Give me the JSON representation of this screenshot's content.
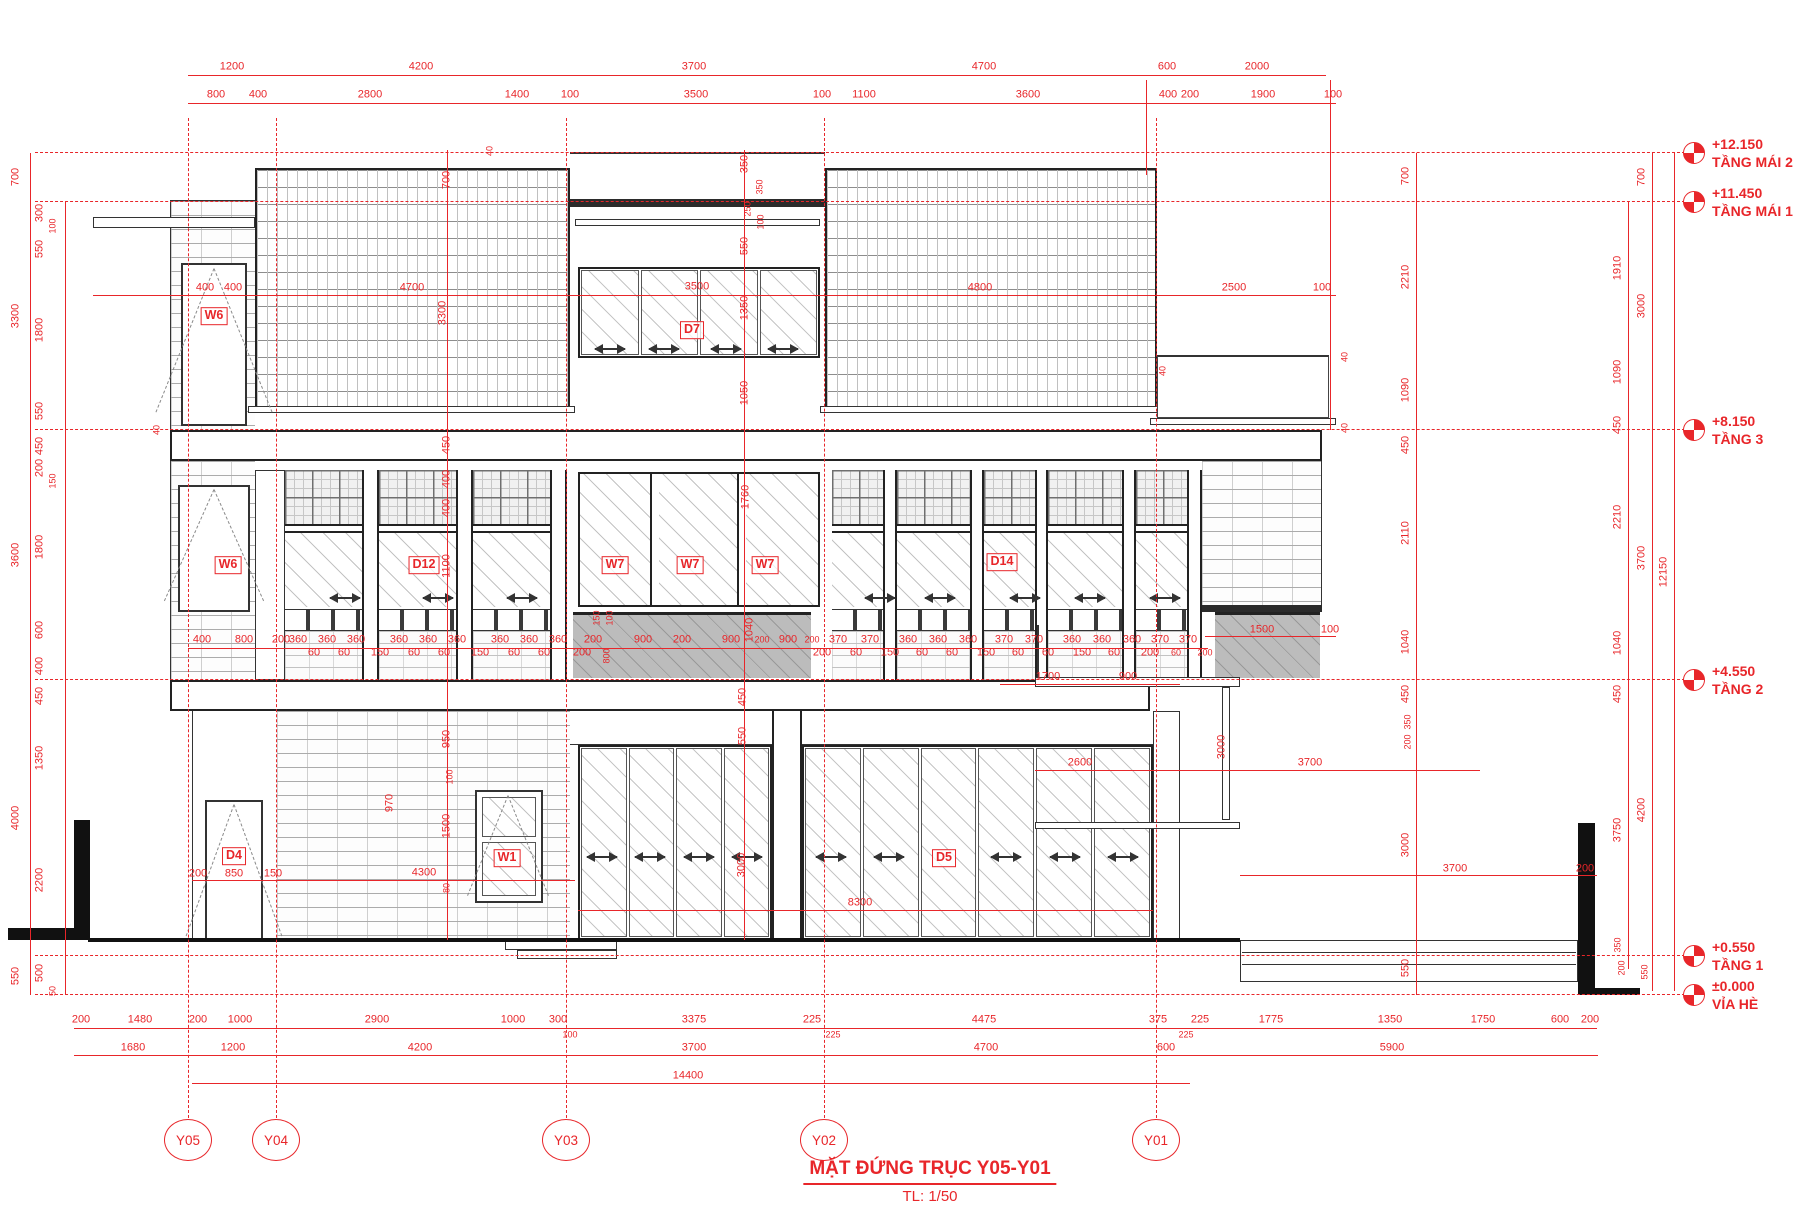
{
  "title": {
    "main": "MẶT ĐỨNG TRỤC Y05-Y01",
    "scale": "TL: 1/50"
  },
  "colors": {
    "red": "#e8262a",
    "line": "#222222"
  },
  "levels": [
    {
      "elev": "+12.150",
      "name": "TẦNG MÁI 2",
      "y": 153
    },
    {
      "elev": "+11.450",
      "name": "TẦNG MÁI 1",
      "y": 202
    },
    {
      "elev": "+8.150",
      "name": "TẦNG 3",
      "y": 430
    },
    {
      "elev": "+4.550",
      "name": "TẦNG 2",
      "y": 680
    },
    {
      "elev": "+0.550",
      "name": "TẦNG 1",
      "y": 956
    },
    {
      "elev": "±0.000",
      "name": "VỈA HÈ",
      "y": 995
    }
  ],
  "axes": [
    {
      "label": "Y05",
      "x": 188
    },
    {
      "label": "Y04",
      "x": 276
    },
    {
      "label": "Y03",
      "x": 566
    },
    {
      "label": "Y02",
      "x": 824
    },
    {
      "label": "Y01",
      "x": 1156
    }
  ],
  "tags": [
    {
      "t": "W6",
      "x": 214,
      "y": 316
    },
    {
      "t": "D7",
      "x": 692,
      "y": 330
    },
    {
      "t": "W6",
      "x": 228,
      "y": 565
    },
    {
      "t": "D12",
      "x": 424,
      "y": 565
    },
    {
      "t": "W7",
      "x": 615,
      "y": 565
    },
    {
      "t": "W7",
      "x": 690,
      "y": 565
    },
    {
      "t": "W7",
      "x": 765,
      "y": 565
    },
    {
      "t": "D14",
      "x": 1002,
      "y": 562
    },
    {
      "t": "D4",
      "x": 234,
      "y": 856
    },
    {
      "t": "W1",
      "x": 507,
      "y": 858
    },
    {
      "t": "D5",
      "x": 944,
      "y": 858
    }
  ],
  "dims": [
    {
      "t": "1200",
      "x": 232,
      "y": 67
    },
    {
      "t": "4200",
      "x": 421,
      "y": 67
    },
    {
      "t": "3700",
      "x": 694,
      "y": 67
    },
    {
      "t": "4700",
      "x": 984,
      "y": 67
    },
    {
      "t": "600",
      "x": 1167,
      "y": 67
    },
    {
      "t": "2000",
      "x": 1257,
      "y": 67
    },
    {
      "t": "800",
      "x": 216,
      "y": 95
    },
    {
      "t": "400",
      "x": 258,
      "y": 95
    },
    {
      "t": "2800",
      "x": 370,
      "y": 95
    },
    {
      "t": "1400",
      "x": 517,
      "y": 95
    },
    {
      "t": "100",
      "x": 570,
      "y": 95
    },
    {
      "t": "3500",
      "x": 696,
      "y": 95
    },
    {
      "t": "100",
      "x": 822,
      "y": 95
    },
    {
      "t": "1100",
      "x": 864,
      "y": 95
    },
    {
      "t": "3600",
      "x": 1028,
      "y": 95
    },
    {
      "t": "400",
      "x": 1168,
      "y": 95
    },
    {
      "t": "200",
      "x": 1190,
      "y": 95
    },
    {
      "t": "1900",
      "x": 1263,
      "y": 95
    },
    {
      "t": "100",
      "x": 1333,
      "y": 95
    },
    {
      "t": "700",
      "x": 16,
      "y": 177,
      "r": 1
    },
    {
      "t": "3300",
      "x": 16,
      "y": 316,
      "r": 1
    },
    {
      "t": "3600",
      "x": 16,
      "y": 555,
      "r": 1
    },
    {
      "t": "4000",
      "x": 16,
      "y": 818,
      "r": 1
    },
    {
      "t": "550",
      "x": 16,
      "y": 976,
      "r": 1
    },
    {
      "t": "300",
      "x": 40,
      "y": 213,
      "r": 1
    },
    {
      "t": "550",
      "x": 40,
      "y": 249,
      "r": 1
    },
    {
      "t": "1800",
      "x": 40,
      "y": 330,
      "r": 1
    },
    {
      "t": "550",
      "x": 40,
      "y": 411,
      "r": 1
    },
    {
      "t": "450",
      "x": 40,
      "y": 446,
      "r": 1
    },
    {
      "t": "200",
      "x": 40,
      "y": 468,
      "r": 1
    },
    {
      "t": "1800",
      "x": 40,
      "y": 547,
      "r": 1
    },
    {
      "t": "600",
      "x": 40,
      "y": 630,
      "r": 1
    },
    {
      "t": "400",
      "x": 40,
      "y": 666,
      "r": 1
    },
    {
      "t": "450",
      "x": 40,
      "y": 696,
      "r": 1
    },
    {
      "t": "1350",
      "x": 40,
      "y": 758,
      "r": 1
    },
    {
      "t": "2200",
      "x": 40,
      "y": 880,
      "r": 1
    },
    {
      "t": "500",
      "x": 40,
      "y": 973,
      "r": 1
    },
    {
      "t": "100",
      "x": 53,
      "y": 226,
      "r": 1,
      "s": 1
    },
    {
      "t": "150",
      "x": 53,
      "y": 481,
      "r": 1,
      "s": 1
    },
    {
      "t": "50",
      "x": 53,
      "y": 991,
      "r": 1,
      "s": 1
    },
    {
      "t": "400",
      "x": 205,
      "y": 288
    },
    {
      "t": "400",
      "x": 233,
      "y": 288
    },
    {
      "t": "4700",
      "x": 412,
      "y": 288
    },
    {
      "t": "3500",
      "x": 697,
      "y": 287
    },
    {
      "t": "4800",
      "x": 980,
      "y": 288
    },
    {
      "t": "2500",
      "x": 1234,
      "y": 288
    },
    {
      "t": "100",
      "x": 1322,
      "y": 288
    },
    {
      "t": "350",
      "x": 745,
      "y": 164,
      "r": 1
    },
    {
      "t": "350",
      "x": 760,
      "y": 187,
      "r": 1,
      "s": 1
    },
    {
      "t": "250",
      "x": 748,
      "y": 209,
      "r": 1,
      "s": 1
    },
    {
      "t": "100",
      "x": 761,
      "y": 222,
      "r": 1,
      "s": 1
    },
    {
      "t": "550",
      "x": 745,
      "y": 246,
      "r": 1
    },
    {
      "t": "1350",
      "x": 745,
      "y": 308,
      "r": 1
    },
    {
      "t": "1050",
      "x": 745,
      "y": 393,
      "r": 1
    },
    {
      "t": "700",
      "x": 447,
      "y": 180,
      "r": 1
    },
    {
      "t": "3300",
      "x": 443,
      "y": 313,
      "r": 1
    },
    {
      "t": "450",
      "x": 447,
      "y": 445,
      "r": 1
    },
    {
      "t": "400",
      "x": 447,
      "y": 479,
      "r": 1
    },
    {
      "t": "400",
      "x": 447,
      "y": 508,
      "r": 1
    },
    {
      "t": "1100",
      "x": 447,
      "y": 566,
      "r": 1
    },
    {
      "t": "950",
      "x": 447,
      "y": 739,
      "r": 1
    },
    {
      "t": "100",
      "x": 450,
      "y": 777,
      "r": 1,
      "s": 1
    },
    {
      "t": "1500",
      "x": 447,
      "y": 826,
      "r": 1
    },
    {
      "t": "80",
      "x": 447,
      "y": 888,
      "r": 1,
      "s": 1
    },
    {
      "t": "970",
      "x": 390,
      "y": 803,
      "r": 1
    },
    {
      "t": "1760",
      "x": 746,
      "y": 497,
      "r": 1
    },
    {
      "t": "1040",
      "x": 750,
      "y": 630,
      "r": 1
    },
    {
      "t": "450",
      "x": 743,
      "y": 697,
      "r": 1
    },
    {
      "t": "550",
      "x": 743,
      "y": 736,
      "r": 1
    },
    {
      "t": "3000",
      "x": 742,
      "y": 865,
      "r": 1
    },
    {
      "t": "40",
      "x": 490,
      "y": 151,
      "r": 1,
      "s": 1
    },
    {
      "t": "40",
      "x": 157,
      "y": 430,
      "r": 1,
      "s": 1
    },
    {
      "t": "40",
      "x": 1163,
      "y": 371,
      "r": 1,
      "s": 1
    },
    {
      "t": "40",
      "x": 1345,
      "y": 357,
      "r": 1,
      "s": 1
    },
    {
      "t": "40",
      "x": 1345,
      "y": 428,
      "r": 1,
      "s": 1
    },
    {
      "t": "700",
      "x": 1406,
      "y": 176,
      "r": 1
    },
    {
      "t": "2210",
      "x": 1406,
      "y": 277,
      "r": 1
    },
    {
      "t": "1090",
      "x": 1406,
      "y": 390,
      "r": 1
    },
    {
      "t": "450",
      "x": 1406,
      "y": 445,
      "r": 1
    },
    {
      "t": "2110",
      "x": 1406,
      "y": 533,
      "r": 1
    },
    {
      "t": "1040",
      "x": 1406,
      "y": 642,
      "r": 1
    },
    {
      "t": "450",
      "x": 1406,
      "y": 694,
      "r": 1
    },
    {
      "t": "350",
      "x": 1408,
      "y": 722,
      "r": 1,
      "s": 1
    },
    {
      "t": "200",
      "x": 1408,
      "y": 742,
      "r": 1,
      "s": 1
    },
    {
      "t": "3000",
      "x": 1406,
      "y": 845,
      "r": 1
    },
    {
      "t": "550",
      "x": 1406,
      "y": 968,
      "r": 1
    },
    {
      "t": "1910",
      "x": 1618,
      "y": 268,
      "r": 1
    },
    {
      "t": "1090",
      "x": 1618,
      "y": 372,
      "r": 1
    },
    {
      "t": "450",
      "x": 1618,
      "y": 425,
      "r": 1
    },
    {
      "t": "2210",
      "x": 1618,
      "y": 517,
      "r": 1
    },
    {
      "t": "1040",
      "x": 1618,
      "y": 643,
      "r": 1
    },
    {
      "t": "450",
      "x": 1618,
      "y": 694,
      "r": 1
    },
    {
      "t": "3750",
      "x": 1618,
      "y": 830,
      "r": 1
    },
    {
      "t": "350",
      "x": 1618,
      "y": 945,
      "r": 1,
      "s": 1
    },
    {
      "t": "200",
      "x": 1622,
      "y": 968,
      "r": 1,
      "s": 1
    },
    {
      "t": "700",
      "x": 1642,
      "y": 177,
      "r": 1
    },
    {
      "t": "3000",
      "x": 1642,
      "y": 306,
      "r": 1
    },
    {
      "t": "3700",
      "x": 1642,
      "y": 558,
      "r": 1
    },
    {
      "t": "4200",
      "x": 1642,
      "y": 810,
      "r": 1
    },
    {
      "t": "550",
      "x": 1645,
      "y": 972,
      "r": 1,
      "s": 1
    },
    {
      "t": "12150",
      "x": 1664,
      "y": 572,
      "r": 1
    },
    {
      "t": "400",
      "x": 202,
      "y": 640
    },
    {
      "t": "800",
      "x": 244,
      "y": 640
    },
    {
      "t": "200",
      "x": 281,
      "y": 640
    },
    {
      "t": "360",
      "x": 298,
      "y": 640
    },
    {
      "t": "360",
      "x": 327,
      "y": 640
    },
    {
      "t": "360",
      "x": 356,
      "y": 640
    },
    {
      "t": "360",
      "x": 399,
      "y": 640
    },
    {
      "t": "360",
      "x": 428,
      "y": 640
    },
    {
      "t": "360",
      "x": 457,
      "y": 640
    },
    {
      "t": "360",
      "x": 500,
      "y": 640
    },
    {
      "t": "360",
      "x": 529,
      "y": 640
    },
    {
      "t": "360",
      "x": 558,
      "y": 640
    },
    {
      "t": "200",
      "x": 593,
      "y": 640
    },
    {
      "t": "900",
      "x": 643,
      "y": 640
    },
    {
      "t": "200",
      "x": 682,
      "y": 640
    },
    {
      "t": "900",
      "x": 731,
      "y": 640
    },
    {
      "t": "200",
      "x": 762,
      "y": 640,
      "s": 1
    },
    {
      "t": "900",
      "x": 788,
      "y": 640
    },
    {
      "t": "200",
      "x": 812,
      "y": 640,
      "s": 1
    },
    {
      "t": "370",
      "x": 838,
      "y": 640
    },
    {
      "t": "370",
      "x": 870,
      "y": 640
    },
    {
      "t": "360",
      "x": 908,
      "y": 640
    },
    {
      "t": "360",
      "x": 938,
      "y": 640
    },
    {
      "t": "360",
      "x": 968,
      "y": 640
    },
    {
      "t": "370",
      "x": 1004,
      "y": 640
    },
    {
      "t": "370",
      "x": 1034,
      "y": 640
    },
    {
      "t": "360",
      "x": 1072,
      "y": 640
    },
    {
      "t": "360",
      "x": 1102,
      "y": 640
    },
    {
      "t": "360",
      "x": 1132,
      "y": 640
    },
    {
      "t": "370",
      "x": 1160,
      "y": 640
    },
    {
      "t": "370",
      "x": 1188,
      "y": 640
    },
    {
      "t": "60",
      "x": 314,
      "y": 653
    },
    {
      "t": "60",
      "x": 344,
      "y": 653
    },
    {
      "t": "150",
      "x": 380,
      "y": 653
    },
    {
      "t": "60",
      "x": 414,
      "y": 653
    },
    {
      "t": "60",
      "x": 444,
      "y": 653
    },
    {
      "t": "150",
      "x": 480,
      "y": 653
    },
    {
      "t": "60",
      "x": 514,
      "y": 653
    },
    {
      "t": "60",
      "x": 544,
      "y": 653
    },
    {
      "t": "200",
      "x": 582,
      "y": 653
    },
    {
      "t": "200",
      "x": 822,
      "y": 653
    },
    {
      "t": "60",
      "x": 856,
      "y": 653
    },
    {
      "t": "150",
      "x": 890,
      "y": 653
    },
    {
      "t": "60",
      "x": 922,
      "y": 653
    },
    {
      "t": "60",
      "x": 952,
      "y": 653
    },
    {
      "t": "150",
      "x": 986,
      "y": 653
    },
    {
      "t": "60",
      "x": 1018,
      "y": 653
    },
    {
      "t": "60",
      "x": 1048,
      "y": 653
    },
    {
      "t": "150",
      "x": 1082,
      "y": 653
    },
    {
      "t": "60",
      "x": 1114,
      "y": 653
    },
    {
      "t": "200",
      "x": 1150,
      "y": 653
    },
    {
      "t": "60",
      "x": 1176,
      "y": 653,
      "s": 1
    },
    {
      "t": "200",
      "x": 1205,
      "y": 653,
      "s": 1
    },
    {
      "t": "150",
      "x": 597,
      "y": 618,
      "r": 1,
      "s": 1
    },
    {
      "t": "100",
      "x": 610,
      "y": 618,
      "r": 1,
      "s": 1
    },
    {
      "t": "800",
      "x": 607,
      "y": 656,
      "r": 1,
      "s": 1
    },
    {
      "t": "1500",
      "x": 1262,
      "y": 630
    },
    {
      "t": "100",
      "x": 1330,
      "y": 630
    },
    {
      "t": "1700",
      "x": 1048,
      "y": 677
    },
    {
      "t": "900",
      "x": 1128,
      "y": 677
    },
    {
      "t": "3000",
      "x": 1222,
      "y": 747,
      "r": 1
    },
    {
      "t": "2600",
      "x": 1080,
      "y": 763
    },
    {
      "t": "3700",
      "x": 1310,
      "y": 763
    },
    {
      "t": "200",
      "x": 198,
      "y": 874
    },
    {
      "t": "850",
      "x": 234,
      "y": 874
    },
    {
      "t": "150",
      "x": 273,
      "y": 874
    },
    {
      "t": "4300",
      "x": 424,
      "y": 873
    },
    {
      "t": "8300",
      "x": 860,
      "y": 903
    },
    {
      "t": "3700",
      "x": 1455,
      "y": 869
    },
    {
      "t": "200",
      "x": 1585,
      "y": 869
    },
    {
      "t": "200",
      "x": 81,
      "y": 1020
    },
    {
      "t": "1480",
      "x": 140,
      "y": 1020
    },
    {
      "t": "200",
      "x": 198,
      "y": 1020
    },
    {
      "t": "1000",
      "x": 240,
      "y": 1020
    },
    {
      "t": "2900",
      "x": 377,
      "y": 1020
    },
    {
      "t": "1000",
      "x": 513,
      "y": 1020
    },
    {
      "t": "300",
      "x": 558,
      "y": 1020
    },
    {
      "t": "3375",
      "x": 694,
      "y": 1020
    },
    {
      "t": "225",
      "x": 812,
      "y": 1020
    },
    {
      "t": "4475",
      "x": 984,
      "y": 1020
    },
    {
      "t": "375",
      "x": 1158,
      "y": 1020
    },
    {
      "t": "225",
      "x": 1200,
      "y": 1020
    },
    {
      "t": "1775",
      "x": 1271,
      "y": 1020
    },
    {
      "t": "1350",
      "x": 1390,
      "y": 1020
    },
    {
      "t": "1750",
      "x": 1483,
      "y": 1020
    },
    {
      "t": "600",
      "x": 1560,
      "y": 1020
    },
    {
      "t": "200",
      "x": 1590,
      "y": 1020
    },
    {
      "t": "100",
      "x": 570,
      "y": 1035,
      "s": 1
    },
    {
      "t": "225",
      "x": 833,
      "y": 1035,
      "s": 1
    },
    {
      "t": "225",
      "x": 1186,
      "y": 1035,
      "s": 1
    },
    {
      "t": "1680",
      "x": 133,
      "y": 1048
    },
    {
      "t": "1200",
      "x": 233,
      "y": 1048
    },
    {
      "t": "4200",
      "x": 420,
      "y": 1048
    },
    {
      "t": "3700",
      "x": 694,
      "y": 1048
    },
    {
      "t": "4700",
      "x": 986,
      "y": 1048
    },
    {
      "t": "600",
      "x": 1166,
      "y": 1048
    },
    {
      "t": "5900",
      "x": 1392,
      "y": 1048
    },
    {
      "t": "14400",
      "x": 688,
      "y": 1076
    }
  ]
}
